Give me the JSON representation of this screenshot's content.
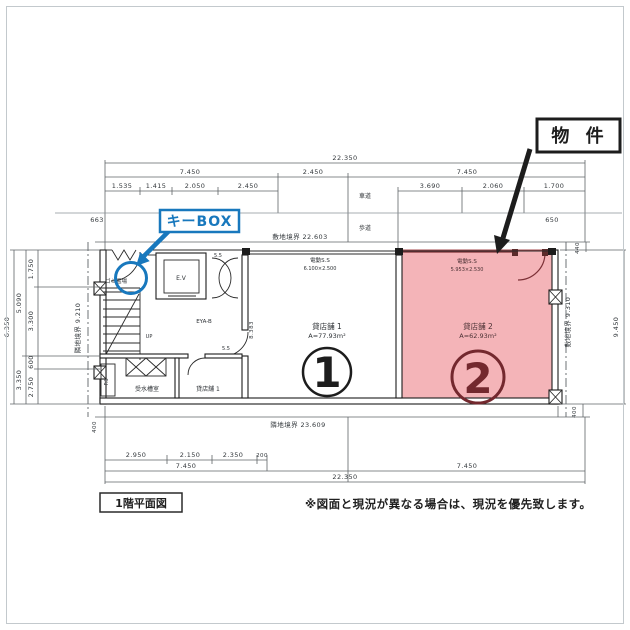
{
  "colors": {
    "highlight": "#f4b4b8",
    "accent_maroon": "#73282e",
    "callout_blue": "#1878bd",
    "ink": "#1c1c1c"
  },
  "callouts": {
    "property": "物 件",
    "keybox": "キーBOX"
  },
  "site": {
    "road_label": "車道",
    "sidewalk_label": "歩道",
    "boundary_top": "敷地境界 22.603",
    "boundary_bottom": "隣地境界 23.609",
    "boundary_left": "隣地境界 9.210",
    "boundary_right": "敷地境界 9.310"
  },
  "dims": {
    "top_total": "22.350",
    "top_row2": [
      "7.450",
      "2.450",
      "7.450"
    ],
    "top_row3_left": [
      "1.535",
      "1.415",
      "2.050",
      "2.450"
    ],
    "top_row3_right": [
      "3.690",
      "2.060",
      "1.700"
    ],
    "setback_left": "663",
    "setback_right": "650",
    "right_top": "440",
    "right_total": "9.450",
    "right_bottom": "400",
    "left_outer": "6.350",
    "left_mid": [
      "5.090",
      "3.350"
    ],
    "left_inner": [
      "1.750",
      "3.300",
      "600",
      "2.750"
    ],
    "left_bottom": "400",
    "bottom_row1": [
      "2.950",
      "2.150",
      "2.350",
      "200"
    ],
    "bottom_row2": [
      "7.450",
      "7.450"
    ],
    "bottom_total": "22.350",
    "inner_height": "8.383"
  },
  "rooms": {
    "ev": "E.V",
    "up": "UP",
    "garbage": "ゴミ置場",
    "tank": "受水槽室",
    "shop1_back": "貸店舗 1",
    "ps": "P.S",
    "hall": "EYA-B",
    "note_a": "5.5",
    "note_b": "5.5"
  },
  "units": {
    "u1": {
      "shutter": "電動S.S",
      "shutter_size": "6.100×2.500",
      "label": "貸店舗 1",
      "area": "A=77.93m²",
      "num": "1"
    },
    "u2": {
      "shutter": "電動S.S",
      "shutter_size": "5.953×2.530",
      "label": "貸店舗 2",
      "area": "A=62.93m²",
      "num": "2"
    }
  },
  "footer": {
    "title": "1階平面図",
    "note": "※図面と現況が異なる場合は、現況を優先致します。"
  }
}
